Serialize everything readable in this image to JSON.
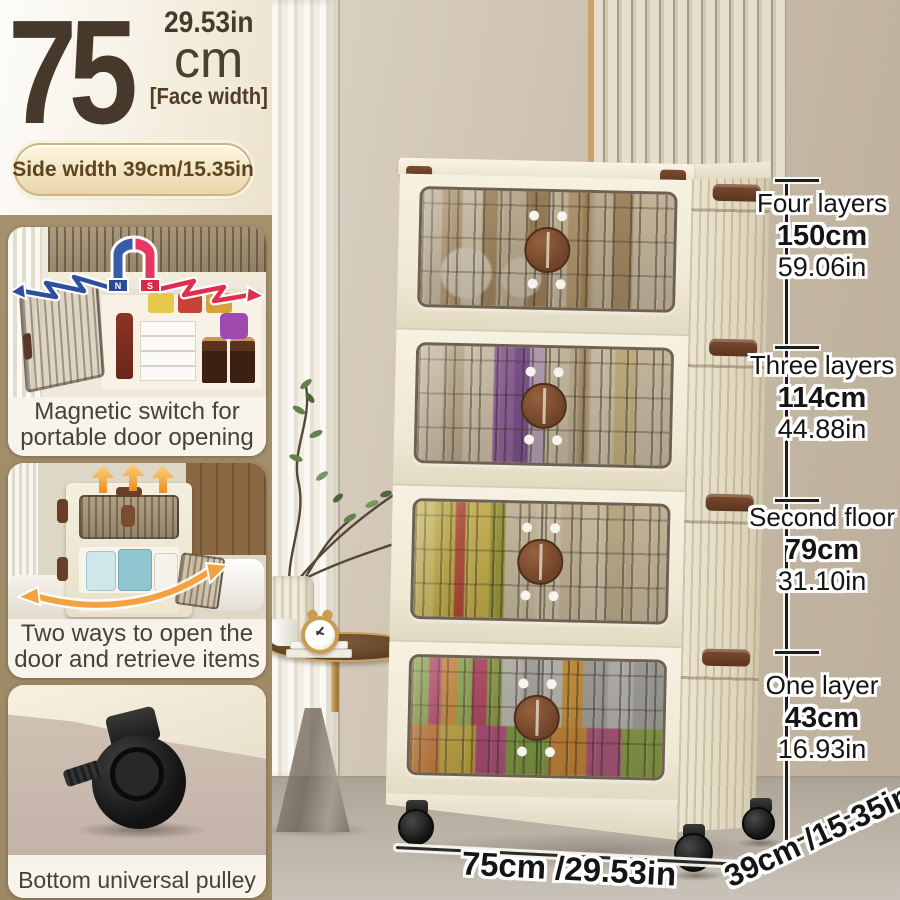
{
  "product_banner": {
    "face_width_value": "75",
    "face_width_unit": "cm",
    "face_width_inches": "29.53in",
    "face_width_label": "[Face width]",
    "side_width_badge": "Side width 39cm/15.35in"
  },
  "feature_cards": [
    {
      "caption": "Magnetic switch for portable door opening",
      "icon": "magnet-icon"
    },
    {
      "caption": "Two ways to open the door and retrieve items",
      "icon": "up-arrows-icon"
    },
    {
      "caption": "Bottom universal pulley",
      "icon": "caster-wheel-icon"
    }
  ],
  "height_measurements": [
    {
      "label": "Four layers",
      "cm": "150cm",
      "inches": "59.06in"
    },
    {
      "label": "Three layers",
      "cm": "114cm",
      "inches": "44.88in"
    },
    {
      "label": "Second floor",
      "cm": "79cm",
      "inches": "31.10in"
    },
    {
      "label": "One layer",
      "cm": "43cm",
      "inches": "16.93in"
    }
  ],
  "base_dimensions": {
    "width_label": "75cm /29.53in",
    "depth_label": "39cm /15.35in"
  },
  "colors": {
    "sidebar_tan": "#a5906e",
    "cabinet_cream": "#f2ecda",
    "handle_brown": "#7a4c30",
    "text_brown": "#46382a",
    "magnet_red": "#e8365f",
    "magnet_blue": "#3b5ca8",
    "arrow_orange": "#ee8d1d",
    "measure_text": "#151515"
  }
}
